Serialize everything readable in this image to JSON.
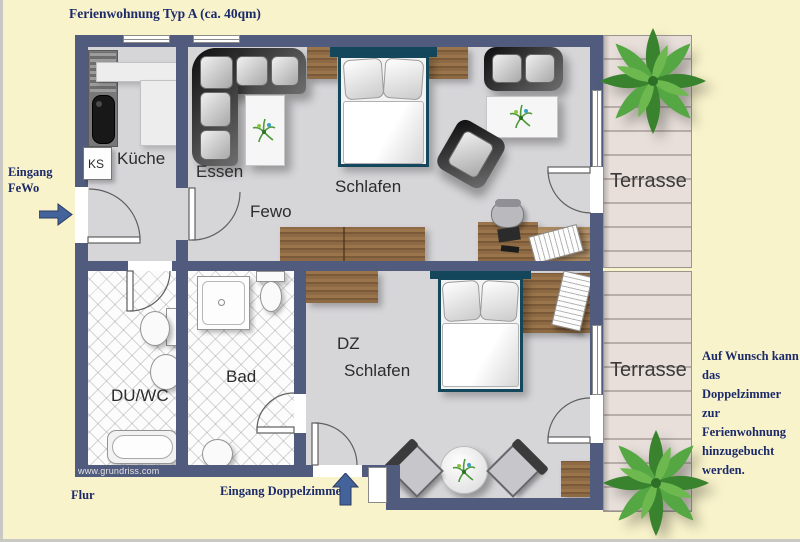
{
  "title": "Ferienwohnung Typ A (ca. 40qm)",
  "annotations": {
    "entrance_fewo": [
      "Eingang",
      "FeWo"
    ],
    "flur": "Flur",
    "entrance_doppelzimmer": "Eingang Doppelzimmer",
    "note": [
      "Auf Wunsch kann",
      "das Doppelzimmer",
      "zur Ferienwohnung",
      "hinzugebucht",
      "werden."
    ],
    "watermark": "www.grundriss.com"
  },
  "rooms": {
    "kueche": "Küche",
    "ks": "KS",
    "essen": "Essen",
    "fewo": "Fewo",
    "schlafen_fewo": "Schlafen",
    "duwc": "DU/WC",
    "bad": "Bad",
    "dz": [
      "DZ",
      "Schlafen"
    ],
    "terrasse_top": "Terrasse",
    "terrasse_bottom": "Terrasse"
  },
  "colors": {
    "background": "#f9f3cb",
    "wall": "#515b7d",
    "floor": "#d6d5d8",
    "tile": "#fcfcfc",
    "wood": "#8d6a43",
    "wood_dark": "#7a5a38",
    "wood_light": "#a8875c",
    "deck": "#e8dfdb",
    "deck_line": "#b7ada9",
    "bed_frame": "#15475c",
    "accent_text": "#1c2a6a",
    "arrow": "#44639b",
    "label_text": "#2c2c2c",
    "plant": "#3f8a33"
  }
}
